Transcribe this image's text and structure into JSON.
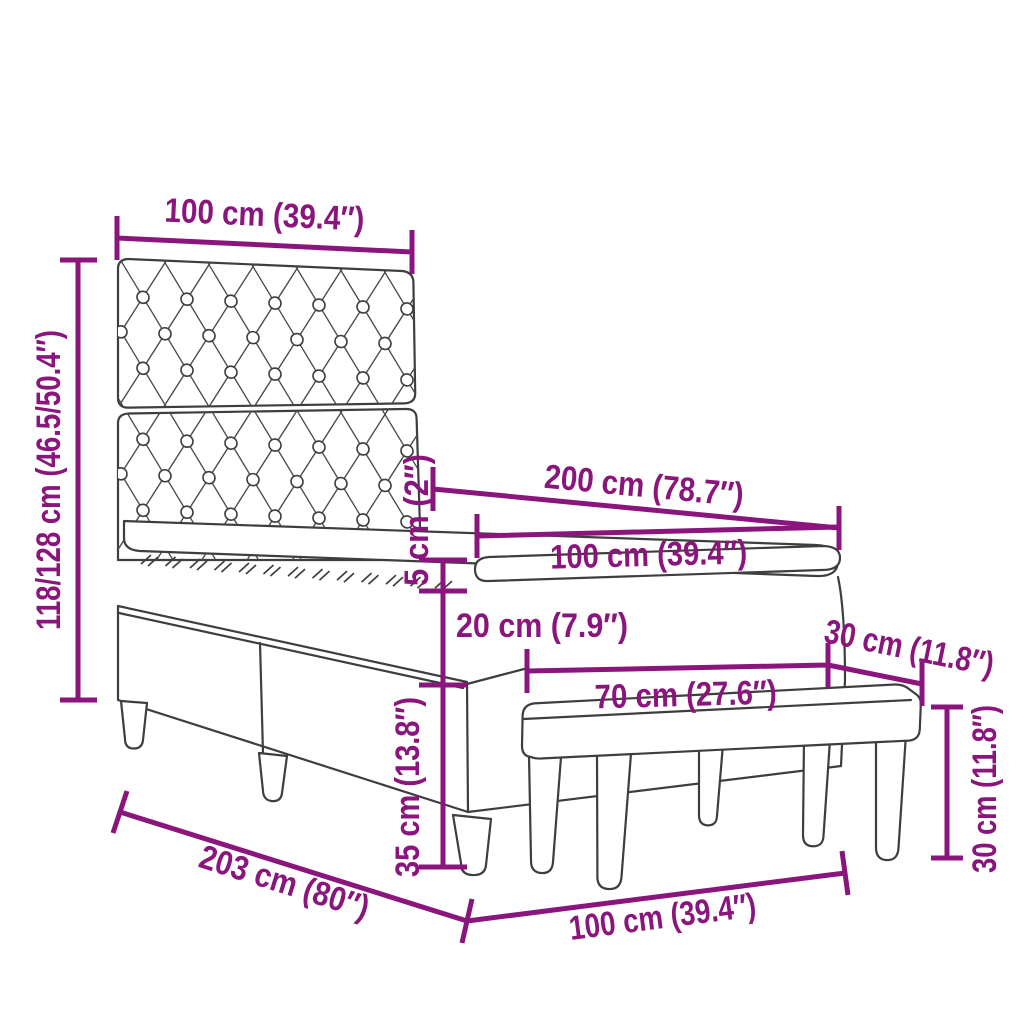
{
  "diagram": {
    "kind": "product-dimension-diagram",
    "subject": "box spring bed with tufted headboard, mattress, topper and bench",
    "colors": {
      "dimension_accent": "#8a157c",
      "outline": "#3e3e3e",
      "background": "#ffffff"
    },
    "labels": {
      "headboard_width": "100 cm (39.4″)",
      "headboard_height": "118/128 cm (46.5/50.4″)",
      "bed_length": "200 cm (78.7″)",
      "mattress_width": "100 cm (39.4″)",
      "topper_height": "5 cm (2″)",
      "mattress_height": "20 cm (7.9″)",
      "base_height": "35 cm (13.8″)",
      "bench_width": "70 cm (27.6″)",
      "bench_depth": "30 cm (11.8″)",
      "bench_height": "30 cm (11.8″)",
      "frame_length": "203 cm (80″)",
      "frame_width": "100 cm (39.4″)"
    }
  }
}
